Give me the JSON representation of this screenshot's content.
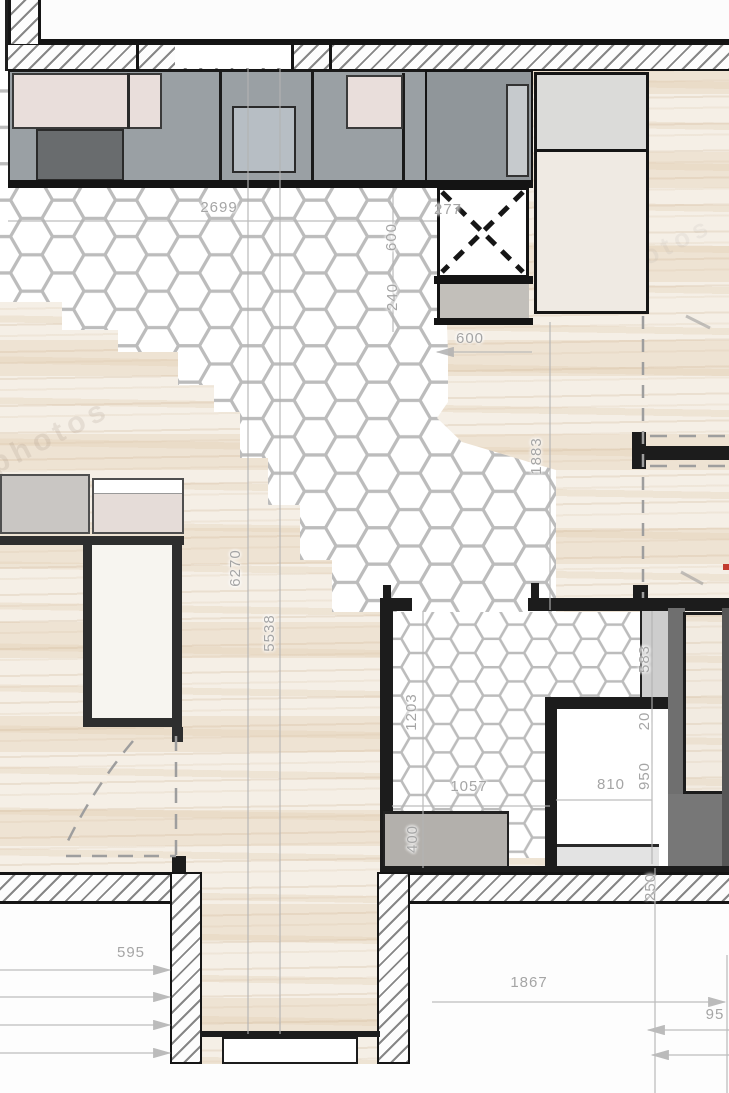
{
  "title": "apartment-floor-plan",
  "watermark": {
    "text": "photos"
  },
  "colors": {
    "wall_line": "#1c1c1c",
    "hatch_line": "#696969",
    "wood_base": "#f5efe6",
    "tile_line": "#bcbcbc",
    "counter_gray": "#9aa0a4",
    "counter_dark": "#696c6e",
    "counter_pink": "#e9dedb",
    "hob_gray": "#b7bec4",
    "dimension_text": "#a5a5a5",
    "accent_red": "#c23b2e"
  },
  "dimensions": {
    "counter_run": "2699",
    "niche": "277",
    "duct_width": "600",
    "duct_depth": "240",
    "clearance": "600",
    "hall_width": "1883",
    "room_length": "6270",
    "room_span": "5538",
    "bath_wall": "1203",
    "bath_width": "1057",
    "shaft": "583",
    "gap": "20",
    "wc_length": "950",
    "wc_width": "810",
    "vanity_depth": "400",
    "wall_thickness": "250",
    "window_left": "595",
    "window_bottom": "1867",
    "offset_right": "95"
  }
}
